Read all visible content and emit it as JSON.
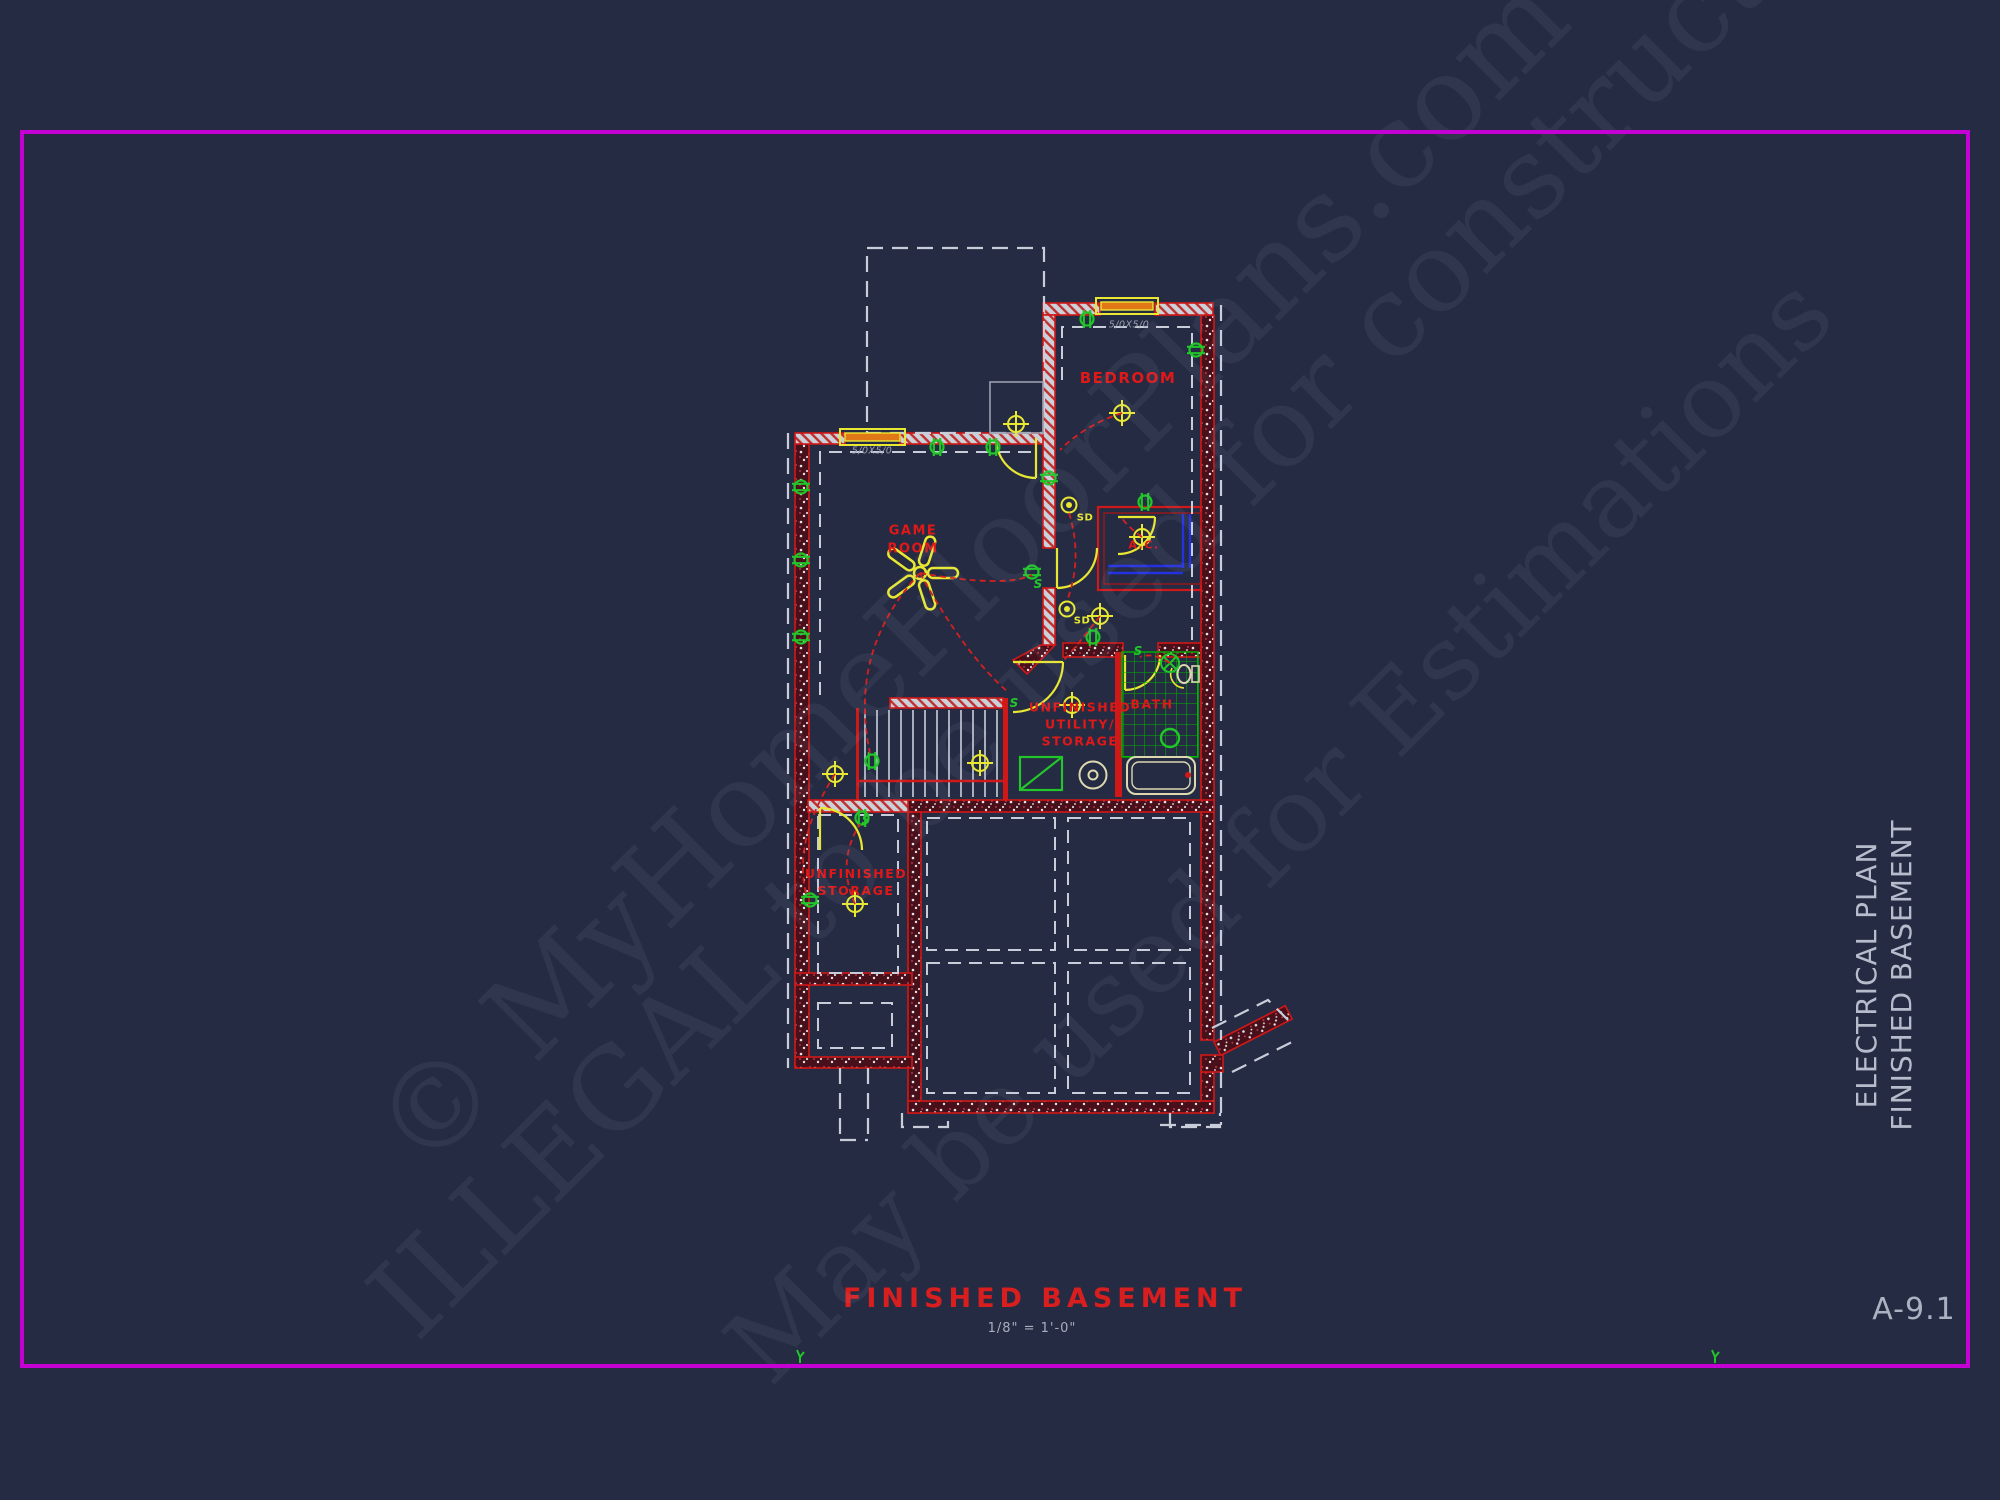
{
  "sheet": {
    "plan_title": "FINISHED BASEMENT",
    "plan_scale": "1/8\" = 1'-0\"",
    "sheet_number": "A-9.1",
    "side_label_line1": "ELECTRICAL PLAN",
    "side_label_line2": "FINISHED BASEMENT"
  },
  "watermark": {
    "line1": "© MyHomeFloorPlans.com",
    "line2": "ILLEGAL to be used for construction",
    "line3": "May be used for Estimations"
  },
  "rooms": {
    "bedroom": "BEDROOM",
    "game_room": "GAME\nROOM",
    "ac_closet": "A.C.",
    "bath": "BATH",
    "utility": "UNFINISHED\nUTILITY/\nSTORAGE",
    "storage": "UNFINISHED\nSTORAGE"
  },
  "annotations": {
    "game_room_window": "5/0X5/0",
    "bedroom_window": "5/0X5/0",
    "smoke_detector": "SD",
    "switch": "S"
  },
  "colors": {
    "background": "#252b42",
    "border_magenta": "#c400d4",
    "wall_red": "#d01818",
    "label_red": "#e01818",
    "electric_green": "#22c52a",
    "symbol_yellow": "#e8e832",
    "window_orange": "#e07818",
    "shelf_blue": "#2331e0",
    "dash_white": "#c8cdd9",
    "text_gray": "#b7bccc",
    "fixture_cream": "#ddd8b0"
  }
}
